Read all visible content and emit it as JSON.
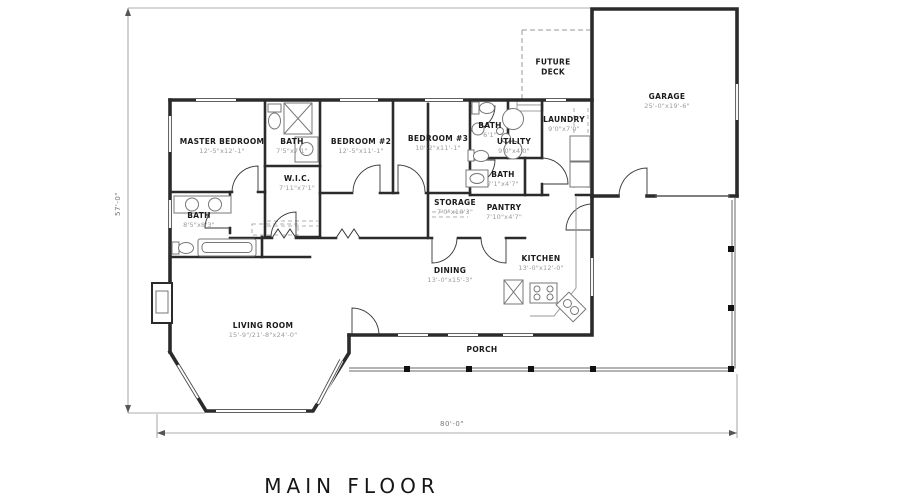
{
  "title": "MAIN  FLOOR",
  "overall_dimensions": {
    "height": "57'-0\"",
    "width": "80'-0\""
  },
  "rooms": {
    "master": {
      "name": "MASTER BEDROOM",
      "dims": "12'-5\"x12'-1\""
    },
    "bath_master": {
      "name": "BATH",
      "dims": "7'5\"x7'1\""
    },
    "bedroom2": {
      "name": "BEDROOM #2",
      "dims": "12'-5\"x11'-1\""
    },
    "bedroom3": {
      "name": "BEDROOM #3",
      "dims": "10'-2\"x11'-1\""
    },
    "wic": {
      "name": "W.I.C.",
      "dims": "7'11\"x7'1\""
    },
    "bath_left": {
      "name": "BATH",
      "dims": "8'5\"x8'3\""
    },
    "bath_top": {
      "name": "BATH",
      "dims": "6'1\""
    },
    "utility": {
      "name": "UTILITY",
      "dims": "9'0\"x4'0\""
    },
    "laundry": {
      "name": "LAUNDRY",
      "dims": "9'0\"x7'0\""
    },
    "bath_mid": {
      "name": "BATH",
      "dims": "7'1\"x4'7\""
    },
    "storage": {
      "name": "STORAGE",
      "dims": "7'0\"x10'3\""
    },
    "pantry": {
      "name": "PANTRY",
      "dims": "7'10\"x4'7\""
    },
    "dining": {
      "name": "DINING",
      "dims": "13'-0\"x15'-3\""
    },
    "kitchen": {
      "name": "KITCHEN",
      "dims": "13'-0\"x12'-0\""
    },
    "living": {
      "name": "LIVING ROOM",
      "dims": "15'-9\"/21'-8\"x24'-0\""
    },
    "garage": {
      "name": "GARAGE",
      "dims": "25'-0\"x19'-6\""
    },
    "porch": {
      "name": "PORCH"
    },
    "deck": {
      "name": "FUTURE DECK"
    }
  },
  "colors": {
    "wall": "#2b2b2b",
    "fixture": "#8a8a8a",
    "dim_line": "#909090",
    "label": "#1b1b1b",
    "dims_text": "#9b9b9b"
  }
}
